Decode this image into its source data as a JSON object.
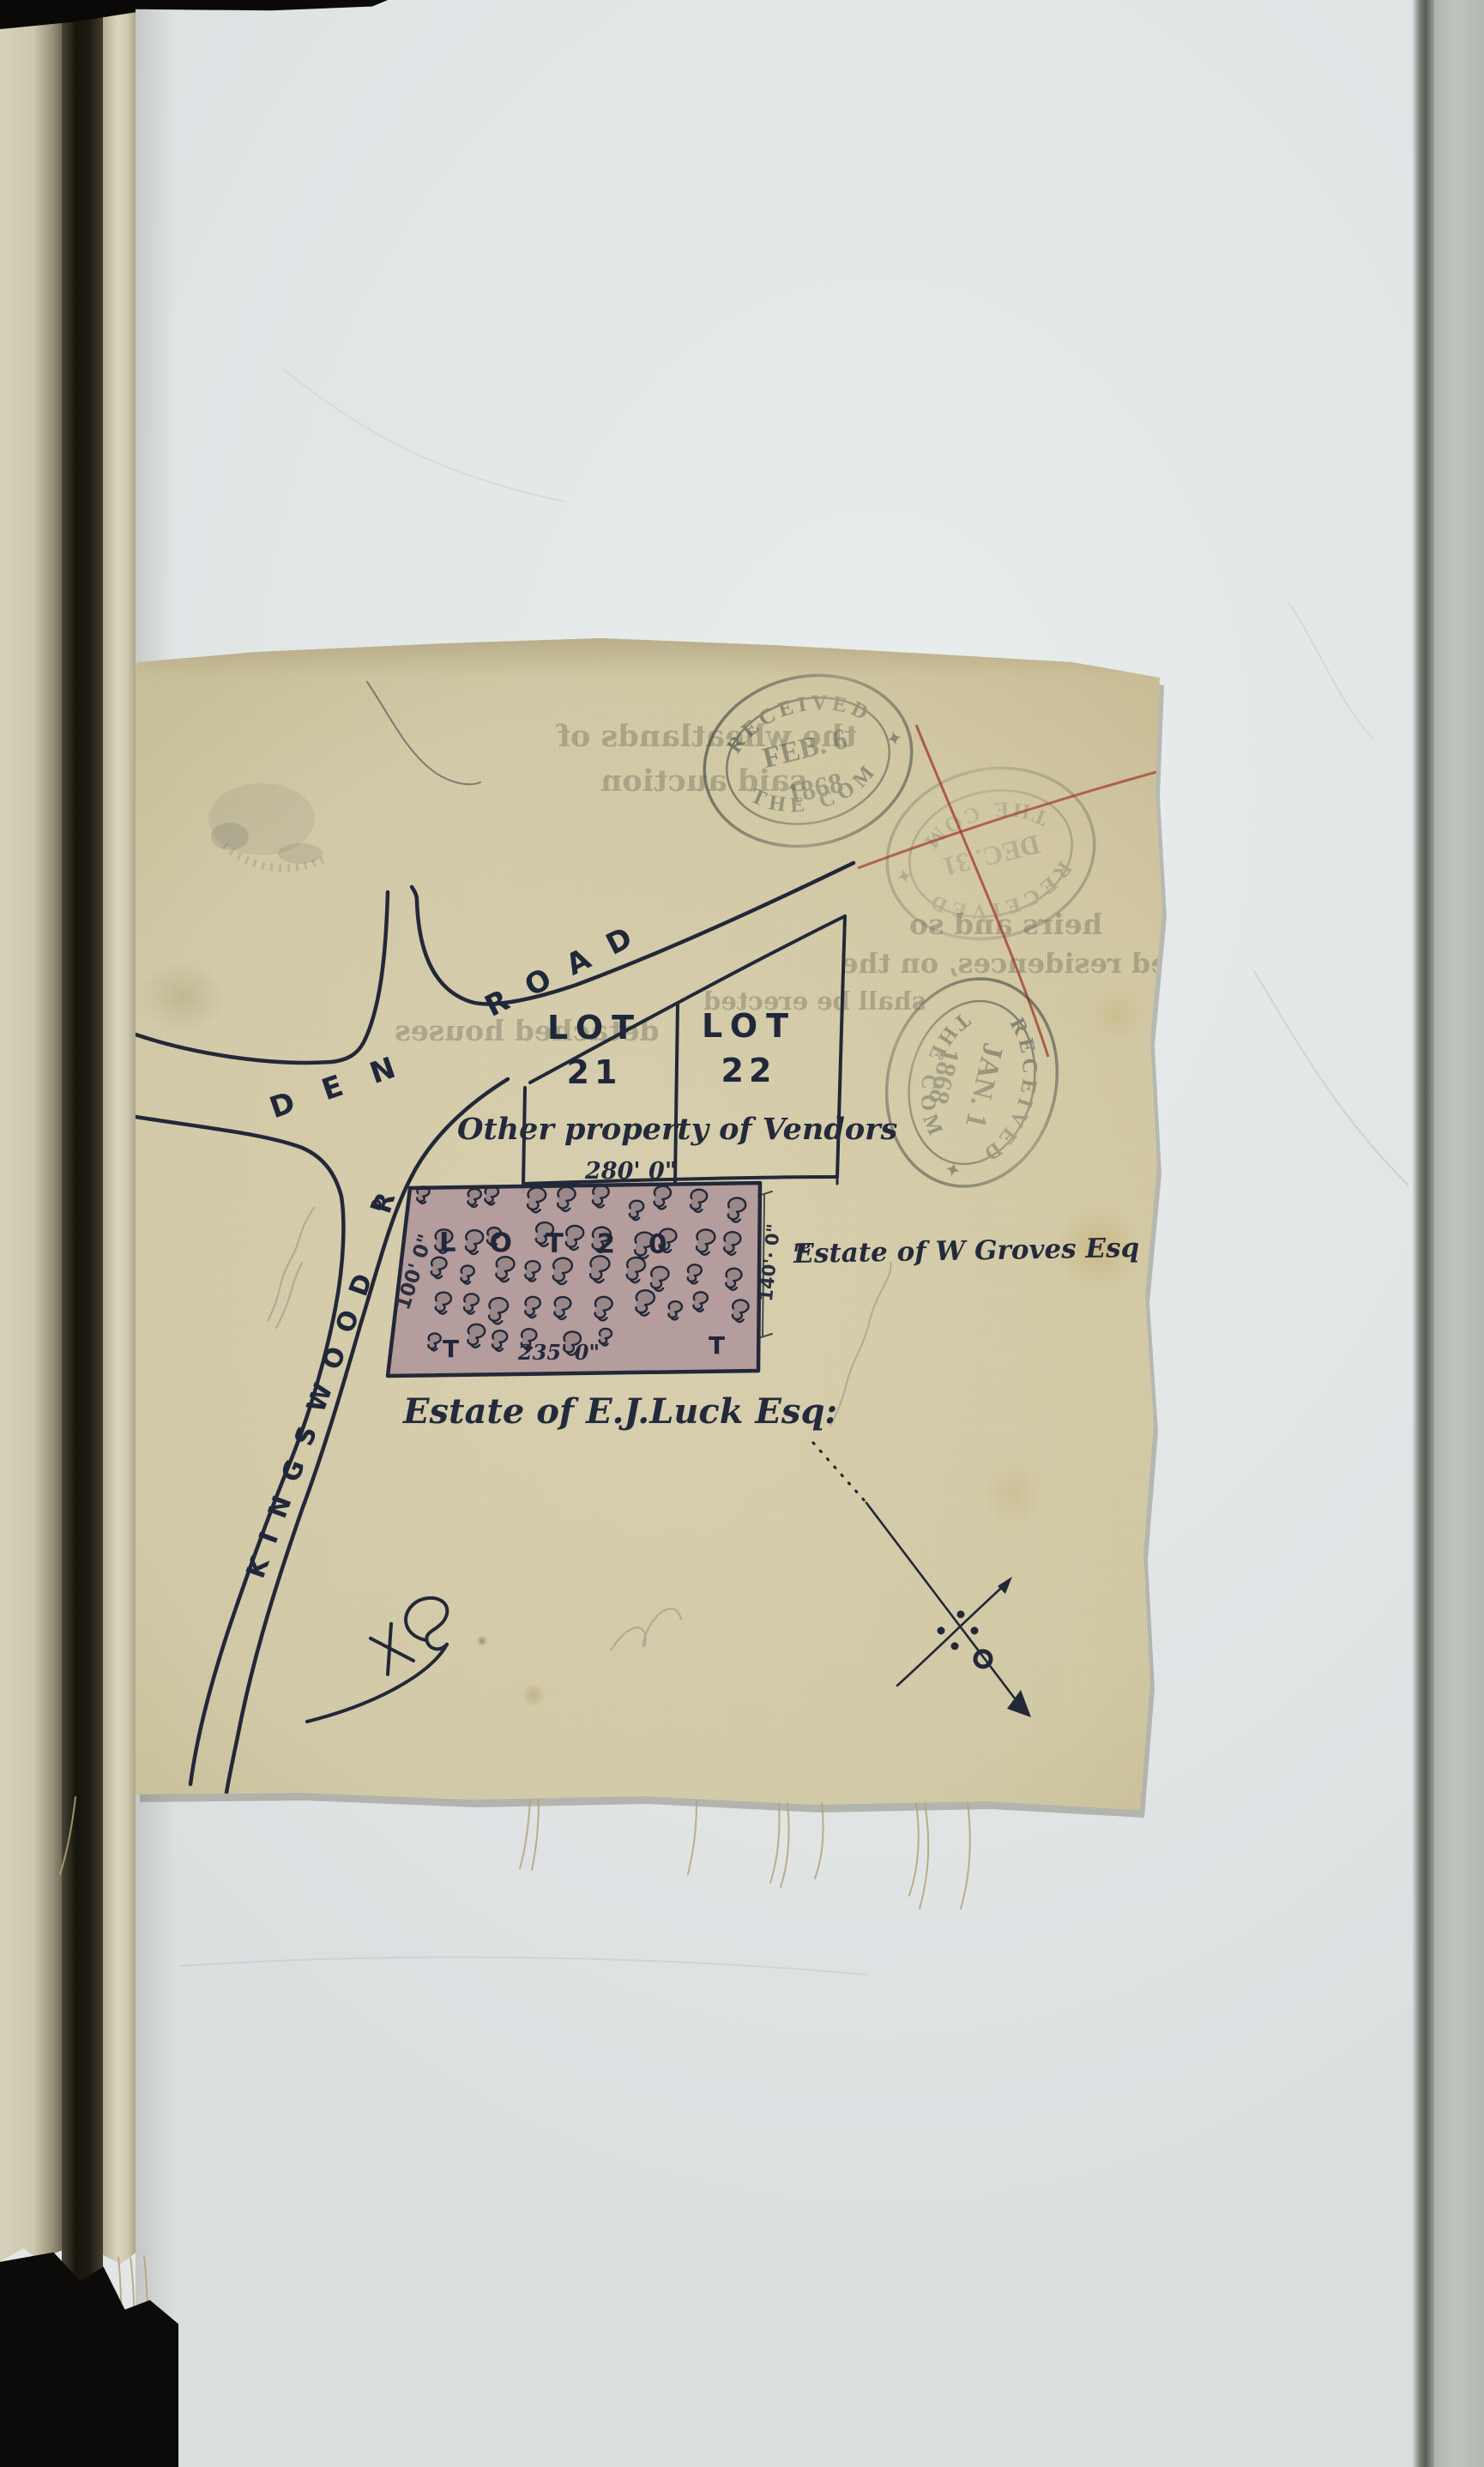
{
  "colors": {
    "ink": "#222838",
    "stamp-ink": "#49514a",
    "red-cross": "#a23d2f",
    "pencil": "#8f8e84",
    "vellum": "#d3cbaa",
    "parcel-fill": "#b2999b",
    "page": "#e2e6e7",
    "thread": "#b3a478"
  },
  "stamps": {
    "received_feb": {
      "arc_top": "RECEIVED",
      "line1": "FEB. 6",
      "line2": "1868",
      "arc_bottom": "THE COM",
      "star": "✦"
    },
    "cancelled": {
      "arc_top": "RECEIVED",
      "line1": "DEC. 31",
      "arc_bottom": "THE COM",
      "star": "✦"
    },
    "received_jan": {
      "arc_top": "RECEIVED",
      "line1": "JAN. 1",
      "line2": "1868",
      "arc_bottom": "THE COM",
      "star": "✦"
    }
  },
  "map": {
    "roads": {
      "den": "DEN",
      "road": "ROAD",
      "kingswood": "KINGSWOOD",
      "rd_abbrev": "R",
      "rd_sup": "D."
    },
    "lots": {
      "lot21": {
        "line1": "LOT",
        "line2": "21"
      },
      "lot22": {
        "line1": "LOT",
        "line2": "22"
      },
      "lot20": "L O T   2 0"
    },
    "labels": {
      "other_property": "Other property of Vendors",
      "estate_groves": "Estate of W Groves Esq",
      "estate_groves_sup": "re",
      "estate_luck": "Estate of E.J.Luck Esq:"
    },
    "dimensions": {
      "top": "280' 0\"",
      "left": "100' 0\"",
      "right": "140'· 0\"",
      "bottom": "235' 0\"",
      "tick_left": "T",
      "tick_right": "T"
    }
  },
  "bleedthrough": {
    "line1": "the wheatlands of",
    "line2": "said auction",
    "line3": "heirs and so",
    "line4": "detached residences, on the",
    "line5": "detached houses",
    "line6": "shall be erected"
  },
  "decor": {
    "tree_count": 46
  }
}
